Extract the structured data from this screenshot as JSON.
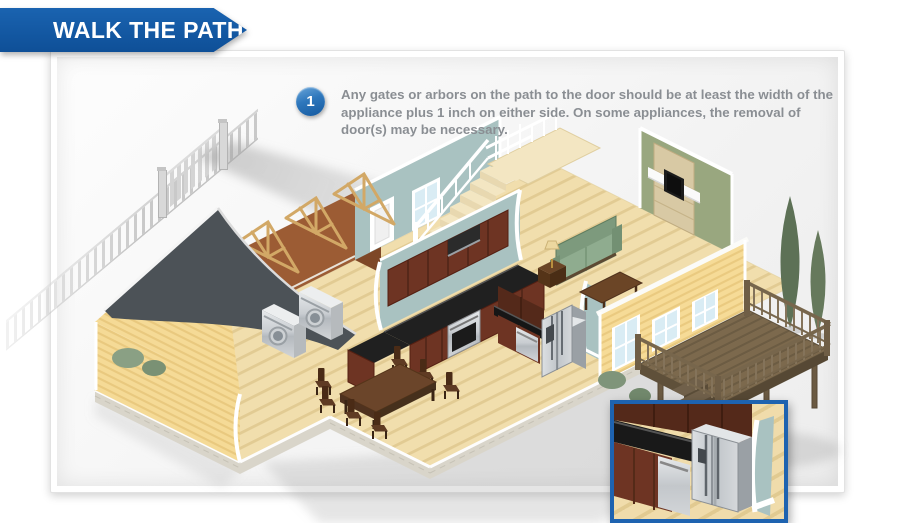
{
  "banner": {
    "title": "WALK THE PATH",
    "background": "#1257a4",
    "text_color": "#ffffff"
  },
  "step": {
    "number": "1",
    "text": "Any gates or arbors on the path to the door should be at least the width of the appliance plus 1 inch on either side. On some appliances, the removal of door(s) may be necessary.",
    "badge_color": "#2066ae",
    "text_color": "#8a8e93"
  },
  "inset": {
    "border_color": "#1e63b0",
    "subject": "refrigerator-corner-detail"
  },
  "scene": {
    "subject": "isometric cutaway house showing the path from the front gate to the refrigerator",
    "elements": [
      "picket-fence",
      "front-gate",
      "walkway-path",
      "gabled-roof",
      "roof-trusses",
      "siding-wall",
      "laundry-room",
      "washer",
      "dryer",
      "kitchen-wall",
      "upper-cabinets",
      "kitchen-counter",
      "range",
      "peninsula-counter",
      "second-kitchen-run",
      "dishwasher",
      "refrigerator",
      "dining-table",
      "dining-chairs",
      "staircase",
      "upper-landing",
      "green-accent-wall",
      "fireplace",
      "sofa",
      "coffee-table",
      "end-table-lamp",
      "yellow-exterior-wall",
      "french-doors",
      "windows",
      "wood-deck",
      "deck-railing",
      "deck-steps",
      "cypress-trees",
      "shrubs",
      "ground-shadows"
    ]
  }
}
